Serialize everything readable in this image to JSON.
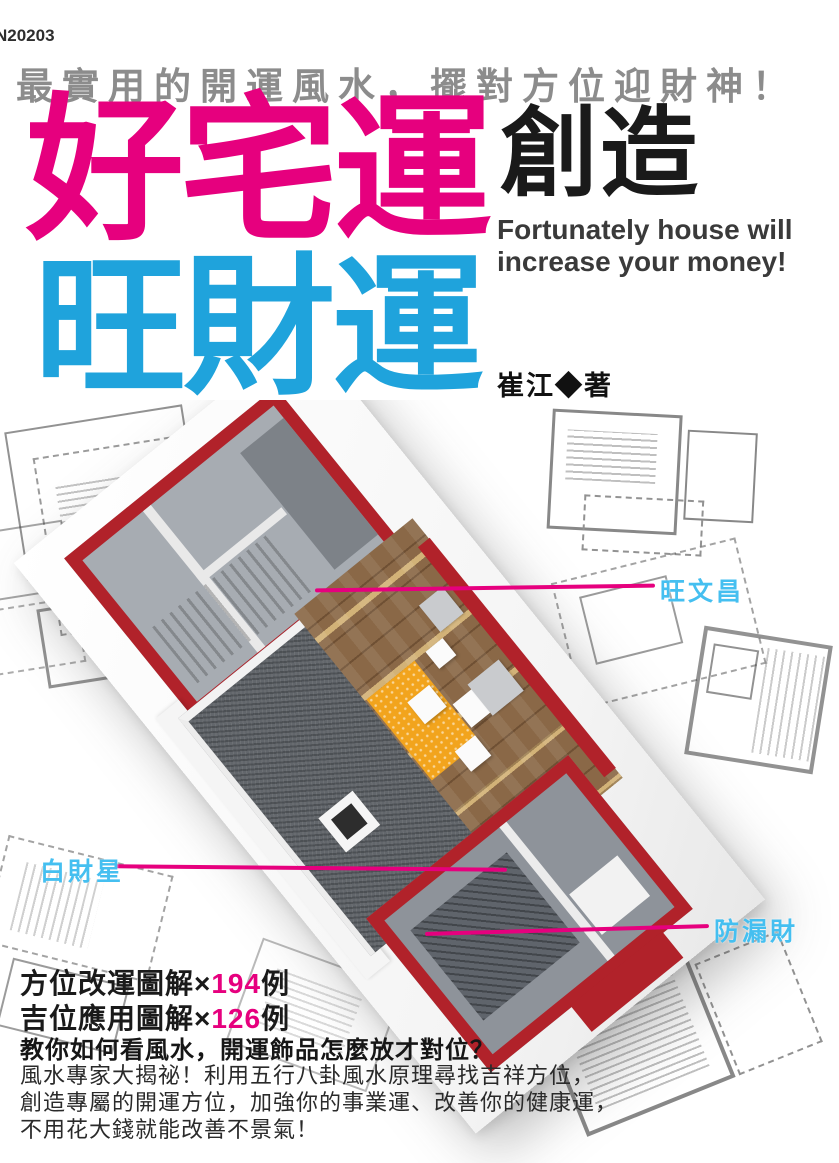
{
  "page": {
    "code": "N20203",
    "tagline": "最實用的開運風水，擺對方位迎財神！",
    "title_pink": "好宅運",
    "subtitle_black": "創造",
    "subtitle_en_line1": "Fortunately house will",
    "subtitle_en_line2": "increase your money!",
    "title_blue": "旺財運",
    "author": "崔江◆著"
  },
  "illustration": {
    "labels": [
      {
        "text": "旺文昌"
      },
      {
        "text": "白財星"
      },
      {
        "text": "防漏財"
      }
    ]
  },
  "footer": {
    "stats": [
      {
        "prefix": "方位改運圖解×",
        "number": "194",
        "suffix": "例"
      },
      {
        "prefix": "吉位應用圖解×",
        "number": "126",
        "suffix": "例"
      }
    ],
    "headline": "教你如何看風水，開運飾品怎麼放才對位？",
    "description_lines": [
      "風水專家大揭祕！利用五行八卦風水原理尋找吉祥方位，",
      "創造專屬的開運方位，加強你的事業運、改善你的健康運，",
      "不用花大錢就能改善不景氣！"
    ]
  },
  "colors": {
    "title_pink": "#E6007E",
    "title_blue": "#1FA3DC",
    "label_blue": "#45BFF0",
    "callout_pink": "#E6007E",
    "wall_red": "#B1222A",
    "tagline_gray": "#8C8C8C"
  }
}
